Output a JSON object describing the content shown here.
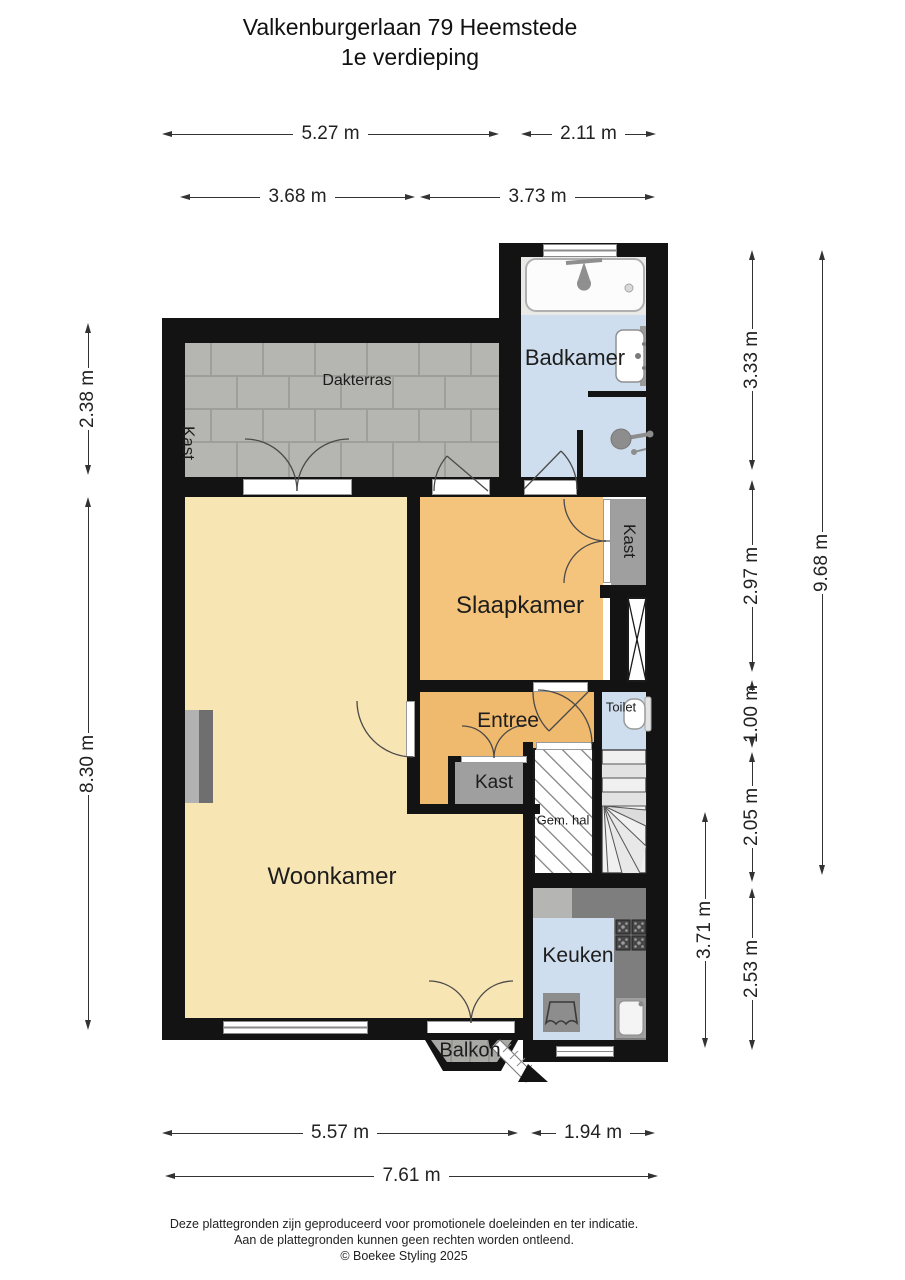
{
  "title": {
    "line1": "Valkenburgerlaan 79 Heemstede",
    "line2": "1e verdieping"
  },
  "rooms": {
    "dakterras": "Dakterras",
    "badkamer": "Badkamer",
    "slaapkamer": "Slaapkamer",
    "woonkamer": "Woonkamer",
    "entree": "Entree",
    "toilet": "Toilet",
    "gemhal": "Gem. hal",
    "keuken": "Keuken",
    "balkon": "Balkon",
    "kast_terras": "Kast",
    "kast_slaapkamer": "Kast",
    "kast_entree": "Kast"
  },
  "dims": {
    "top1": [
      "5.27 m",
      "2.11 m"
    ],
    "top2": [
      "3.68 m",
      "3.73 m"
    ],
    "bottom1": [
      "5.57 m",
      "1.94 m"
    ],
    "bottom2": [
      "7.61 m"
    ],
    "left": [
      "2.38 m",
      "8.30 m"
    ],
    "right": [
      "3.33 m",
      "2.97 m",
      "1.00 m",
      "2.05 m",
      "2.53 m"
    ],
    "right_total": "9.68 m",
    "right_kitchen": "3.71 m"
  },
  "footer": {
    "line1": "Deze plattegronden zijn geproduceerd voor promotionele doeleinden en ter indicatie.",
    "line2": "Aan de plattegronden kunnen geen rechten worden ontleend.",
    "copyright": "© Boekee Styling 2025"
  },
  "colors": {
    "wall": "#131313",
    "woonkamer": "#f8e5b4",
    "slaapkamer": "#f5c47c",
    "entree": "#efb96e",
    "wet_room_blue": "#cfdeee",
    "terrace_tile": "#b5b5b1",
    "kast_grey": "#9f9f9f",
    "counter_grey": "#7e7e7e"
  },
  "fixtures": [
    "bathtub",
    "bath-faucet",
    "washbasin",
    "shower",
    "toilet",
    "stove",
    "kitchen-sink",
    "kitchen-counter",
    "dining-table",
    "stairs",
    "fireplace",
    "wardrobe",
    "x-shaft"
  ]
}
